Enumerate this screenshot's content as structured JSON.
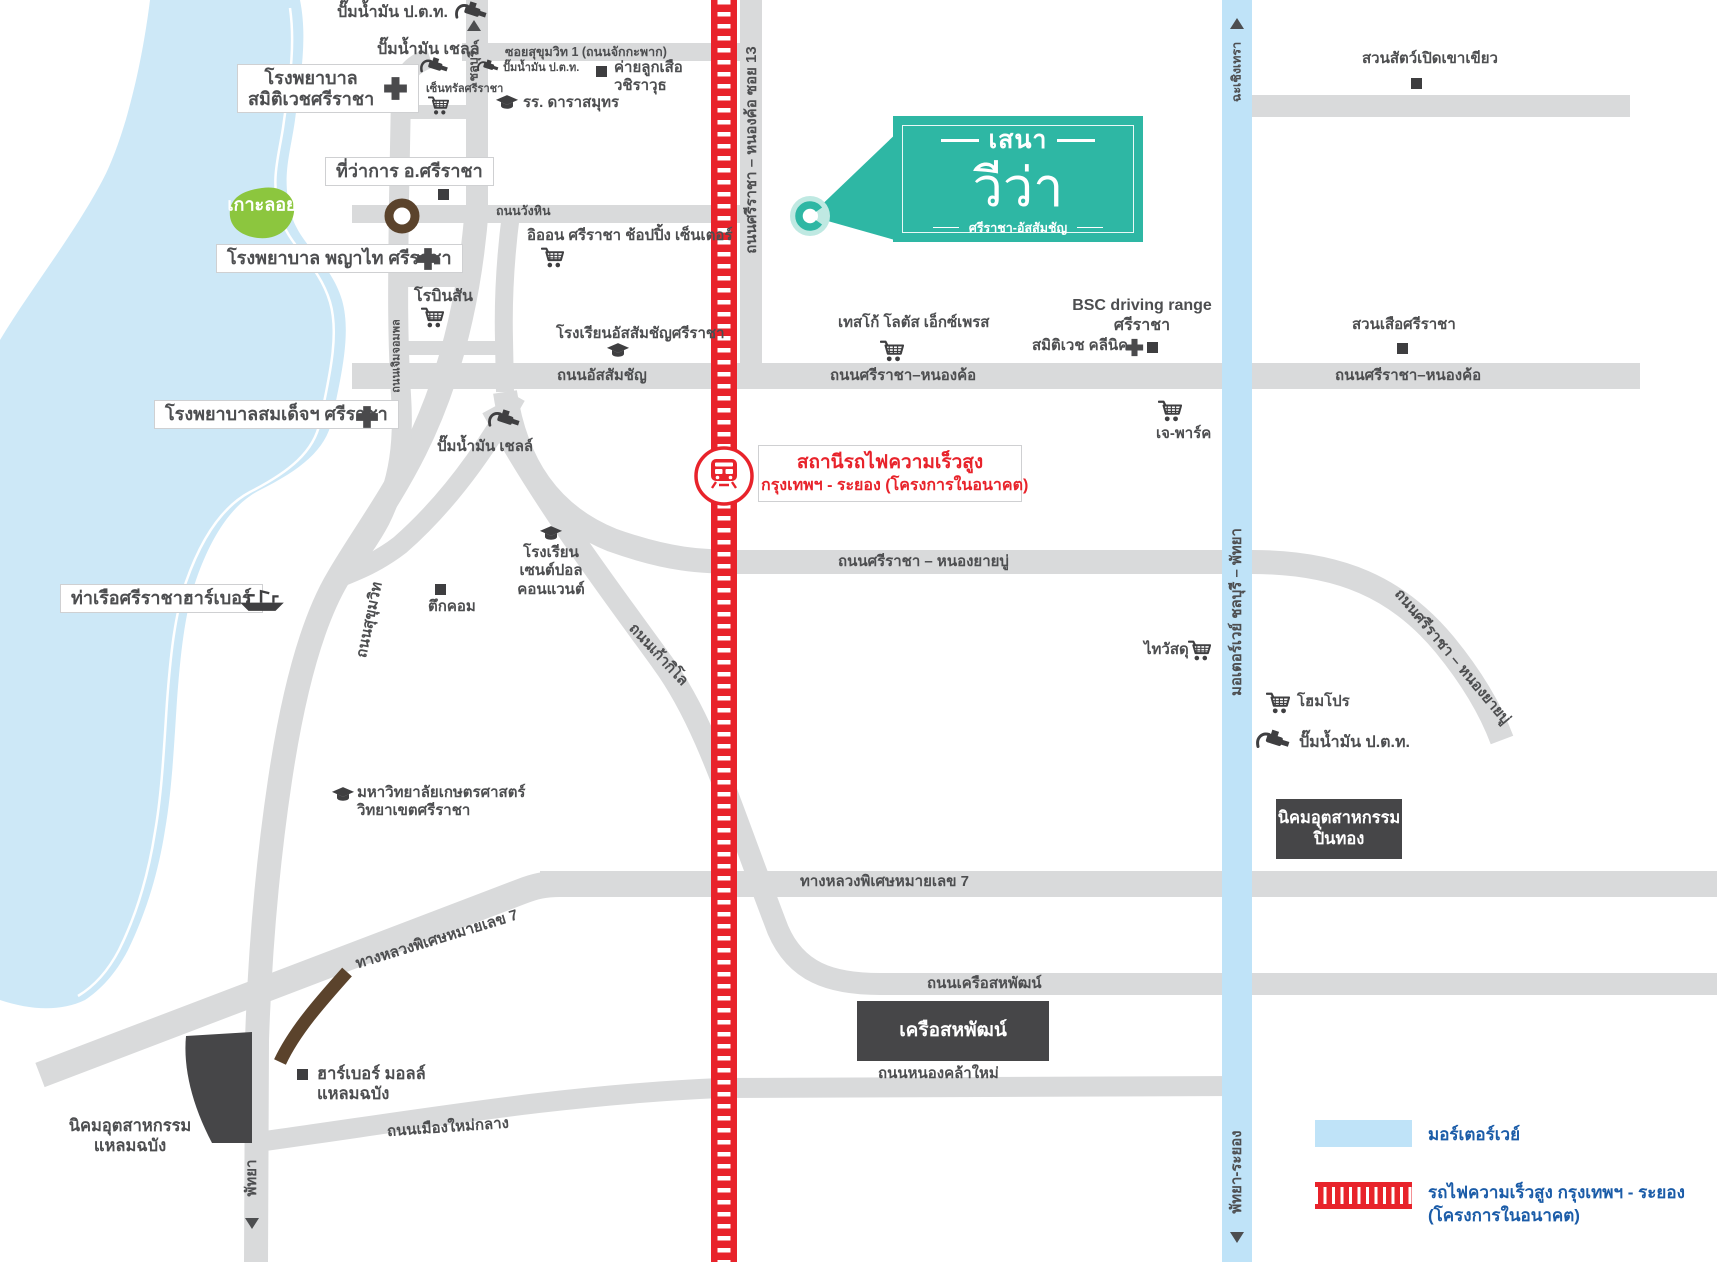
{
  "colors": {
    "water": "#cde8f7",
    "road": "#d9dadb",
    "rail_red": "#e8232b",
    "motorway_blue": "#bfe3f8",
    "island_green": "#8cc63e",
    "brand_teal": "#2eb7a4",
    "legend_blue": "#1b5ca8",
    "dark_box": "#464648",
    "label_gray": "#4d4e50",
    "ramp_brown": "#5b432c"
  },
  "logo": {
    "brand": "เสนา",
    "name": "วีว่า",
    "sub": "ศรีราชา-อัสสัมชัญ"
  },
  "station": {
    "line1": "สถานีรถไฟความเร็วสูง",
    "line2": "กรุงเทพฯ - ระยอง (โครงการในอนาคต)"
  },
  "legend": {
    "motorway": "มอร์เตอร์เวย์",
    "hsr_line1": "รถไฟความเร็วสูง กรุงเทพฯ - ระยอง",
    "hsr_line2": "(โครงการในอนาคต)"
  },
  "directions": {
    "chonburi": "ชลบุรี",
    "chachoengsao": "ฉะเชิงเทรา",
    "motorway_band": "มอเตอร์เวย์ ชลบุรี – พัทยา",
    "pattaya_rayong": "พัทยา-ระยอง",
    "pattaya": "พัทยา"
  },
  "roads": {
    "soi_sukhumvit1": "ซอยสุขุมวิท 1 (ถนนจักกะพาก)",
    "wang_hin": "ถนนวังหิน",
    "assumption": "ถนนอัสสัมชัญ",
    "sriracha_nongkho": "ถนนศรีราชา–หนองค้อ",
    "sriracha_nongkho_right": "ถนนศรีราชา–หนองค้อ",
    "soi13": "ถนนศรีราชา – หนองค้อ ซอย 13",
    "jermjompol": "ถนนเจิมจอมพล",
    "sukhumvit": "ถนนสุขุมวิท",
    "kao_kilo": "ถนนเก้ากิโล",
    "nong_yai_bu": "ถนนศรีราชา – หนองยายบู่",
    "nong_yai_bu_diag": "ถนนศรีราชา – หนองยายบู่",
    "motorway7": "ทางหลวงพิเศษหมายเลข 7",
    "motorway7_diag": "ทางหลวงพิเศษหมายเลข 7",
    "khrue_sahapat": "ถนนเครือสหพัฒน์",
    "nong_kla_mai": "ถนนหนองคล้าใหม่",
    "mueang_mai_klang": "ถนนเมืองใหม่กลาง"
  },
  "places": {
    "koh_loi": "เกาะลอย",
    "ptt_north": "ปั๊มน้ำมัน ป.ต.ท.",
    "shell_north": "ปั๊มน้ำมัน เชลล์",
    "samitivej_l1": "โรงพยาบาล",
    "samitivej_l2": "สมิติเวชศรีราชา",
    "central": "เซ็นทรัลศรีราชา",
    "ptt_soi1": "ปั๊มน้ำมัน ป.ต.ท.",
    "scout_l1": "ค่ายลูกเสือ",
    "scout_l2": "วชิราวุธ",
    "darasamut": "รร. ดาราสมุทร",
    "district_office": "ที่ว่าการ อ.ศรีราชา",
    "aeon": "อิออน ศรีราชา ช้อปปิ้ง เซ็นเตอร์",
    "phyathai": "โรงพยาบาล พญาไท ศรีราชา",
    "robinson": "โรบินสัน",
    "assumption_school": "โรงเรียนอัสสัมชัญศรีราชา",
    "somdej": "โรงพยาบาลสมเด็จฯ ศรีราชา",
    "shell_mid": "ปั๊มน้ำมัน เชลล์",
    "tesco": "เทสโก้ โลตัส เอ็กซ์เพรส",
    "bsc_l1": "BSC driving range",
    "bsc_l2": "ศรีราชา",
    "samitivej_clinic": "สมิติเวช คลีนิค",
    "tiger_zoo": "สวนเสือศรีราชา",
    "khao_kheow_zoo": "สวนสัตว์เปิดเขาเขียว",
    "jpark": "เจ-พาร์ค",
    "st_paul_l1": "โรงเรียน",
    "st_paul_l2": "เซนต์ปอล",
    "st_paul_l3": "คอนแวนต์",
    "tukcom": "ตึกคอม",
    "harbor_pier": "ท่าเรือศรีราชาฮาร์เบอร์",
    "kasetsart_l1": "มหาวิทยาลัยเกษตรศาสตร์",
    "kasetsart_l2": "วิทยาเขตศรีราชา",
    "thai_watsadu": "ไทวัสดุ",
    "homepro": "โฮมโปร",
    "ptt_east": "ปั๊มน้ำมัน ป.ต.ท.",
    "pinthong_l1": "นิคมอุตสาหกรรม",
    "pinthong_l2": "ปิ่นทอง",
    "saha_group": "เครือสหพัฒน์",
    "harbor_mall_l1": "ฮาร์เบอร์ มอลล์",
    "harbor_mall_l2": "แหลมฉบัง",
    "laem_chabang_l1": "นิคมอุตสาหกรรม",
    "laem_chabang_l2": "แหลมฉบัง"
  }
}
